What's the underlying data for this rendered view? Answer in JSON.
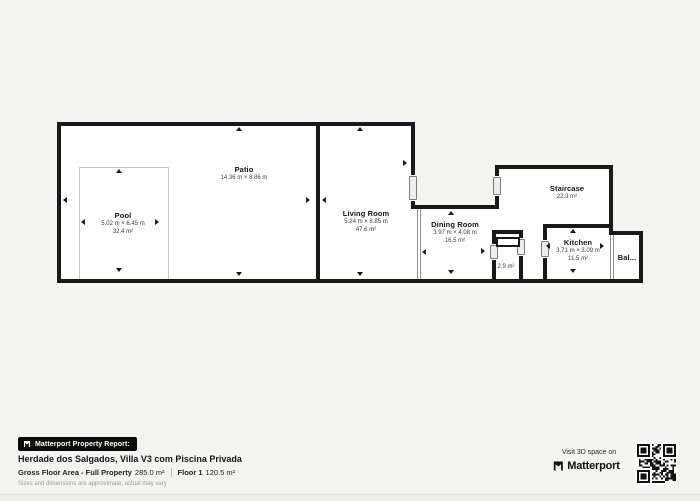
{
  "floorplan": {
    "rooms": [
      {
        "name": "Patio",
        "dims": "14.36 m × 8.86 m"
      },
      {
        "name": "Pool",
        "dims": "5.02 m × 6.45 m",
        "area": "32.4 m²"
      },
      {
        "name": "Living Room",
        "dims": "5.24 m × 8.85 m",
        "area": "47.6 m²"
      },
      {
        "name": "Dining Room",
        "dims": "3.97 m × 4.08 m",
        "area": "16.5 m²"
      },
      {
        "name": "Staircase",
        "area": "22.3 m²"
      },
      {
        "name": "Kitchen",
        "dims": "3.71 m × 3.09 m",
        "area": "11.5 m²"
      },
      {
        "area": "2.9 m²"
      },
      {
        "name": "Bal..."
      }
    ]
  },
  "report": {
    "badge_label": "Matterport Property Report:",
    "property_name": "Herdade dos Salgados, Villa V3 com Piscina Privada",
    "gross_label": "Gross Floor Area - Full Property",
    "gross_value": "285.0 m²",
    "floor_label": "Floor 1",
    "floor_value": "120.5 m²",
    "disclaimer": "Sizes and dimensions are approximate, actual may vary"
  },
  "footer_right": {
    "visit_label": "Visit 3D space on",
    "brand": "Matterport"
  },
  "colors": {
    "background": "#f5f3f0",
    "wall": "#191919",
    "room_fill": "#ffffff",
    "badge_bg": "#0d0d0d"
  }
}
